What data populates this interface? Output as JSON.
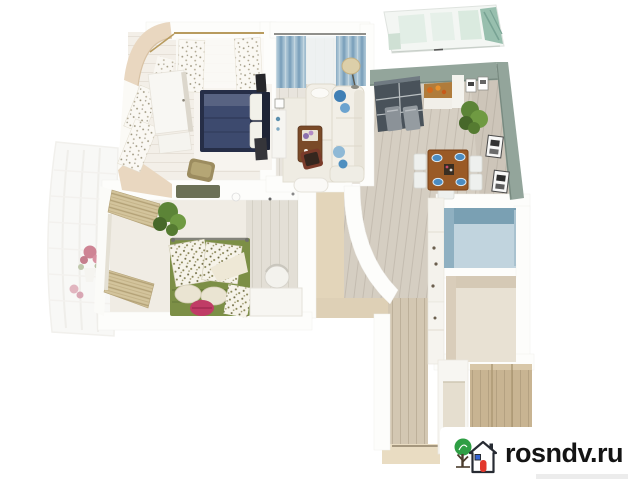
{
  "image": {
    "description": "3D isometric rendering of a two-room apartment floor plan on a white background",
    "width_px": 632,
    "height_px": 480
  },
  "watermark": {
    "text": "rosndv.ru",
    "icons": [
      "tree-icon",
      "house-icon"
    ],
    "colors": {
      "text": "#141414",
      "tree": "#2e9e44",
      "trunk": "#4a3c2c",
      "house_outline": "#272b33",
      "door": "#e2372c",
      "window": "#3565d4",
      "background": "#ffffff"
    }
  },
  "floorplan": {
    "rooms": [
      {
        "name": "master-bedroom",
        "furniture": [
          "navy-double-bed",
          "white-wardrobe",
          "patterned-curtains",
          "tv",
          "armchair"
        ]
      },
      {
        "name": "living-room",
        "furniture": [
          "white-corner-sofa",
          "blue-curtains",
          "coffee-table",
          "floor-lamp",
          "console",
          "accent-chair"
        ]
      },
      {
        "name": "kitchen-dining",
        "furniture": [
          "glass-cabinet",
          "counter-with-fruit",
          "bar-stools",
          "dining-table",
          "blue-plates",
          "plant",
          "wall-pictures"
        ]
      },
      {
        "name": "second-bedroom",
        "furniture": [
          "green-bed",
          "floral-pillows",
          "pink-pillow",
          "desk",
          "chair",
          "plant",
          "bamboo-blinds",
          "ceiling-vent"
        ]
      },
      {
        "name": "bathroom",
        "furniture": []
      },
      {
        "name": "storage-room",
        "furniture": []
      },
      {
        "name": "corridor",
        "furniture": [
          "hall-cabinets",
          "entry-threshold"
        ]
      },
      {
        "name": "wardrobe-closet",
        "furniture": [
          "open-shelving"
        ]
      },
      {
        "name": "glazed-balcony-top",
        "furniture": []
      },
      {
        "name": "left-balcony",
        "furniture": [
          "red-flowers"
        ]
      }
    ],
    "palette": {
      "bed_navy": "#3d4a6e",
      "bed_green": "#7c8f46",
      "pink_pillow": "#c03c66",
      "sofa_pillow_blue": "#3f7fb5",
      "curtain_blue": "#9fbccf",
      "kitchen_wall_sage": "#93a59b",
      "bathroom_wall_blue": "#7aa0b3",
      "bathroom_floor_blue": "#c1d4de",
      "dining_table_wood": "#9a5a26",
      "corridor_wood": "#d3c7b2",
      "wardrobe_wood": "#c8b492",
      "plant_green": "#5c8437",
      "flowers_red": "#b13a54",
      "balcony_glass_teal": "#98bfae",
      "outer_wall_beige": "#e9d7c0"
    }
  }
}
